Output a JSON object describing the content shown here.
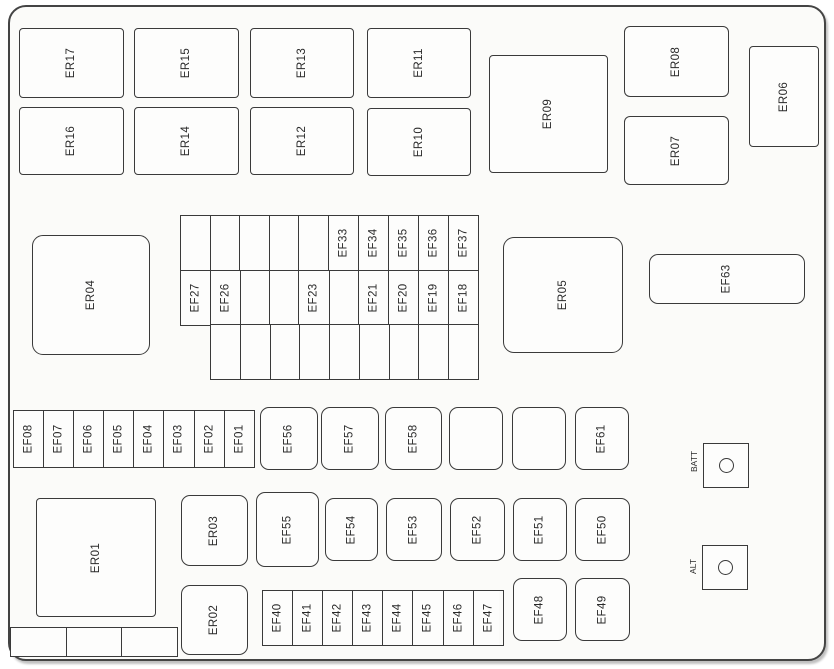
{
  "colors": {
    "line": "#3a3a3a",
    "text": "#2a2a2a",
    "background": "#fbfbf9"
  },
  "top_section": {
    "row1": [
      "ER17",
      "ER15",
      "ER13",
      "ER11"
    ],
    "row2": [
      "ER16",
      "ER14",
      "ER12",
      "ER10"
    ],
    "er09": "ER09",
    "er08": "ER08",
    "er07": "ER07",
    "er06": "ER06"
  },
  "middle_section": {
    "er04": "ER04",
    "er05": "ER05",
    "ef63": "EF63",
    "grid_top_row": [
      "",
      "",
      "",
      "",
      "",
      "EF33",
      "EF34",
      "EF35",
      "EF36",
      "EF37"
    ],
    "grid_middle_row": [
      "EF27",
      "EF26",
      "",
      "",
      "EF23",
      "",
      "EF21",
      "EF20",
      "EF19",
      "EF18"
    ],
    "grid_bottom_row": [
      "",
      "",
      "",
      "",
      "",
      "",
      "",
      "",
      ""
    ]
  },
  "fuse_row_upper": {
    "strip": [
      "EF08",
      "EF07",
      "EF06",
      "EF05",
      "EF04",
      "EF03",
      "EF02",
      "EF01"
    ],
    "squares": [
      "EF56",
      "EF57",
      "EF58",
      "",
      "",
      "EF61"
    ]
  },
  "lower_section": {
    "er01": "ER01",
    "er03": "ER03",
    "squares": [
      "EF55",
      "EF54",
      "EF53",
      "EF52",
      "EF51",
      "EF50"
    ],
    "er02": "ER02",
    "strip": [
      "EF40",
      "EF41",
      "EF42",
      "EF43",
      "EF44",
      "EF45",
      "EF46",
      "EF47"
    ],
    "ef48": "EF48",
    "ef49": "EF49",
    "blank_strip": [
      "",
      "",
      ""
    ]
  },
  "terminals": {
    "batt": "BATT",
    "alt": "ALT"
  }
}
